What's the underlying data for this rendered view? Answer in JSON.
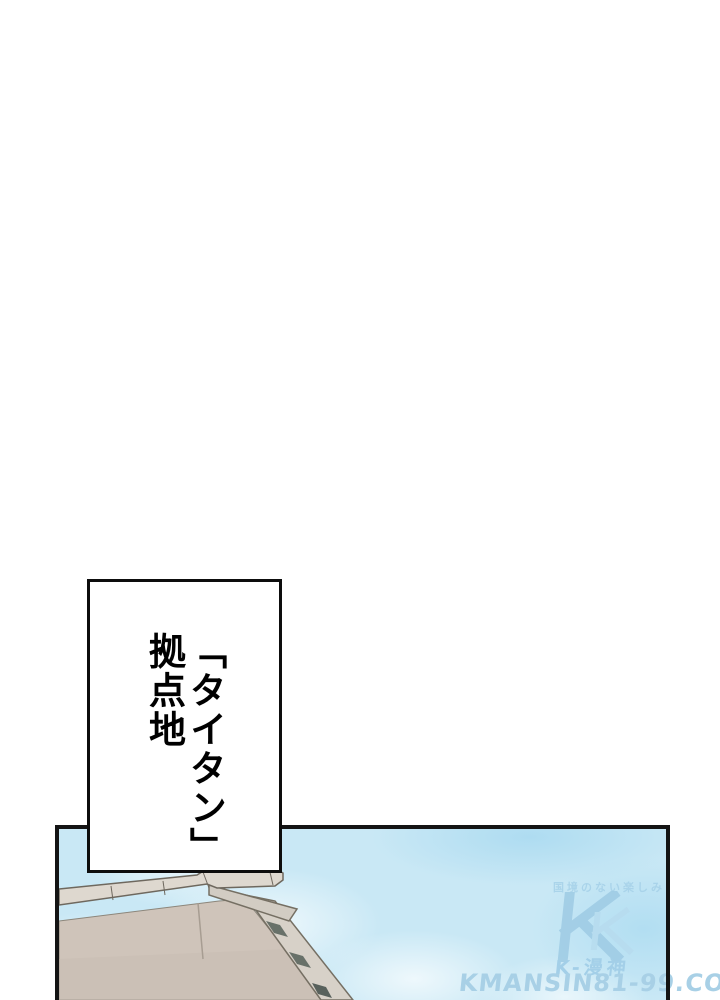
{
  "caption": {
    "text": "「タイタン」\n拠点地"
  },
  "panel": {
    "border_color": "#141414",
    "sky": {
      "base_color": "#c9e8f5",
      "cloud_color": "#ecf7fb",
      "deep_color": "#aedcf1"
    },
    "roof": {
      "surface_color": "#cfc4ba",
      "ridge_color": "#ded8cf",
      "fascia_color": "#d2ccc3",
      "bargeboard_color": "#d7d1c8",
      "outline_color": "#6e685e",
      "insert_color": "#5c665e"
    },
    "watermark": {
      "tagline": "国境のない楽しみ",
      "brand": "K-漫神",
      "site": "KMANSIN81-99.COM",
      "color": "#9ecbe4"
    }
  }
}
